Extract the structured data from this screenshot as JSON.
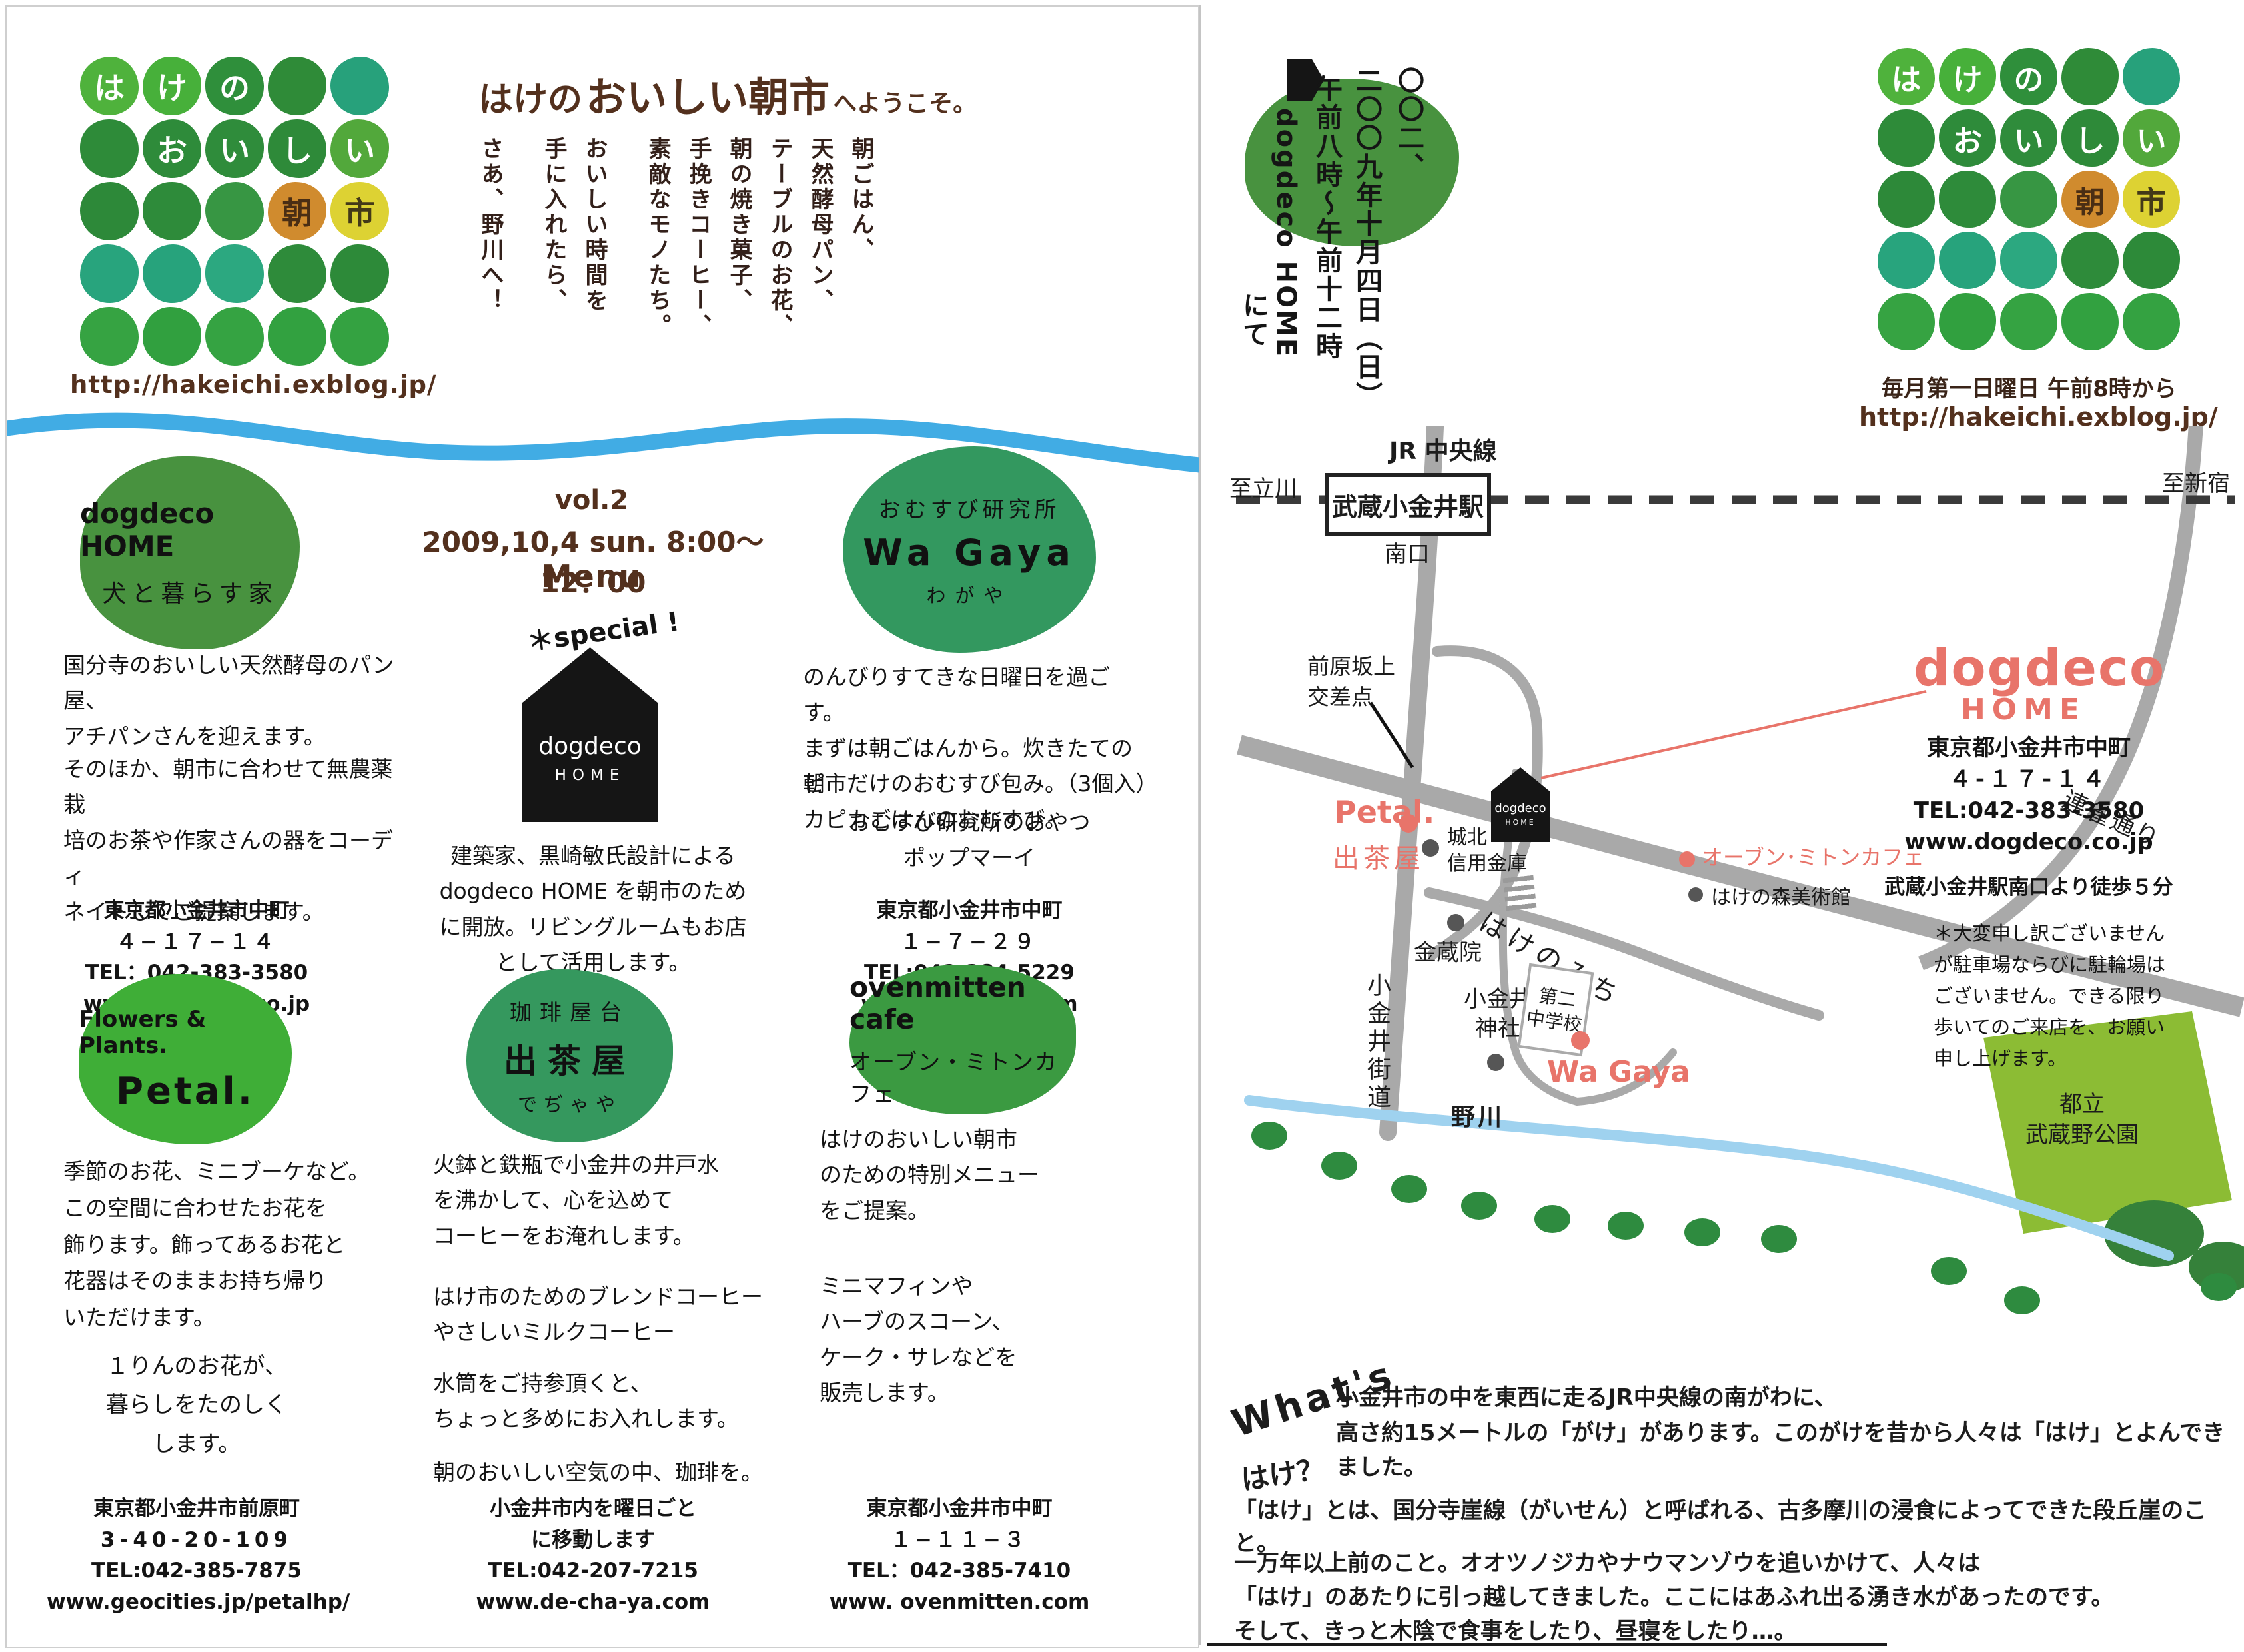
{
  "colors": {
    "brown": "#53301d",
    "pink": "#e8746a",
    "wave_blue": "#41ace4",
    "river_blue": "#9fd2ef",
    "road_gray": "#a9a9a9",
    "park_green": "#8cbc34",
    "tree_green": "#2e8b3f"
  },
  "logo": {
    "url": "http://hakeichi.exblog.jp/",
    "cells": [
      {
        "c": "は",
        "bg": "#4fb23c"
      },
      {
        "c": "け",
        "bg": "#47b03a"
      },
      {
        "c": "の",
        "bg": "#2f8f3b"
      },
      {
        "c": "",
        "bg": "#2f8b38"
      },
      {
        "c": "",
        "bg": "#27a17b"
      },
      {
        "c": "",
        "bg": "#2e8b39"
      },
      {
        "c": "お",
        "bg": "#2e8b3a"
      },
      {
        "c": "い",
        "bg": "#2f8c3b"
      },
      {
        "c": "し",
        "bg": "#2e8a39"
      },
      {
        "c": "い",
        "bg": "#52a83b"
      },
      {
        "c": "",
        "bg": "#2d8939"
      },
      {
        "c": "",
        "bg": "#2e8b3a"
      },
      {
        "c": "",
        "bg": "#379643"
      },
      {
        "c": "朝",
        "bg": "#d08b2e",
        "fg": "#4a2e14"
      },
      {
        "c": "市",
        "bg": "#ddd233",
        "fg": "#433918"
      },
      {
        "c": "",
        "bg": "#28a47d"
      },
      {
        "c": "",
        "bg": "#27a37c"
      },
      {
        "c": "",
        "bg": "#2ca880"
      },
      {
        "c": "",
        "bg": "#2e8b3a"
      },
      {
        "c": "",
        "bg": "#2d8a39"
      },
      {
        "c": "",
        "bg": "#36a342"
      },
      {
        "c": "",
        "bg": "#31a03f"
      },
      {
        "c": "",
        "bg": "#35a342"
      },
      {
        "c": "",
        "bg": "#32a140"
      },
      {
        "c": "",
        "bg": "#34a241"
      }
    ]
  },
  "welcome": {
    "title_1": "はけの",
    "title_2": "おいしい朝市",
    "title_3": "へようこそ。",
    "lines": [
      "朝ごはん、",
      "天然酵母パン、",
      "テーブルのお花、",
      "朝の焼き菓子、",
      "手挽きコーヒー、",
      "素敵なモノたち。",
      "おいしい時間を",
      "手に入れたら、",
      "さあ、野川へ！"
    ]
  },
  "vendors": {
    "dogdeco": {
      "circle_1": "dogdeco HOME",
      "circle_2": "犬と暮らす家",
      "para_1": "国分寺のおいしい天然酵母のパン屋、\nアチパンさんを迎えます。",
      "para_2": "そのほか、朝市に合わせて無農薬栽\n培のお茶や作家さんの器をコーディ\nネイトしてご提案します。",
      "addr": [
        "東京都小金井市中町",
        "４−１７−１４",
        "TEL：042-383-3580",
        "www.dogdeco.co.jp"
      ]
    },
    "event": {
      "vol": "vol.2",
      "date": "2009,10,4 sun. 8:00〜12：00",
      "menu": "Menu",
      "special": "＊special !",
      "house_1": "dogdeco",
      "house_2": "HOME",
      "para": "建築家、黒崎敏氏設計による\ndogdeco HOME を朝市のため\nに開放。リビングルームもお店\nとして活用します。"
    },
    "wagaya": {
      "circle_1": "おむすび研究所",
      "circle_2": "Wa Gaya",
      "circle_3": "わがや",
      "para_1": "のんびりすてきな日曜日を過ごす。\nまずは朝ごはんから。炊きたてのピ\nカピカごはんのおむすび。",
      "para_2": "朝市だけのおむすび包み。（3個入）",
      "para_3": "おむすび研究所のおやつ\nポップマーイ",
      "addr": [
        "東京都小金井市中町",
        "１−７−２９",
        "TEL:042-384-5229",
        "www.wa-gaya.com"
      ]
    },
    "petal": {
      "circle_1": "Flowers & Plants.",
      "circle_2": "Petal.",
      "para_1": "季節のお花、ミニブーケなど。\nこの空間に合わせたお花を\n飾ります。飾ってあるお花と\n花器はそのままお持ち帰り\nいただけます。",
      "para_2": "１りんのお花が、\n暮らしをたのしく\nします。",
      "addr": [
        "東京都小金井市前原町",
        "3-40-20-109",
        "TEL:042-385-7875",
        "www.geocities.jp/petalhp/"
      ]
    },
    "dechaya": {
      "circle_1": "珈琲屋台",
      "circle_2": "出茶屋",
      "circle_3": "でぢゃや",
      "para_1": "火鉢と鉄瓶で小金井の井戸水\nを沸かして、心を込めて\nコーヒーをお淹れします。",
      "para_2": "はけ市のためのブレンドコーヒー\nやさしいミルクコーヒー",
      "para_3": "水筒をご持参頂くと、\nちょっと多めにお入れします。",
      "para_4": "朝のおいしい空気の中、珈琲を。",
      "addr": [
        "小金井市内を曜日ごと",
        "に移動します",
        "TEL:042-207-7215",
        "www.de-cha-ya.com"
      ]
    },
    "ovenmitten": {
      "circle_1": "ovenmitten cafe",
      "circle_2": "オーブン・ミトンカフェ",
      "para_1": "はけのおいしい朝市\nのための特別メニュー\nをご提案。",
      "para_2": "ミニマフィンや\nハーブのスコーン、\nケーク・サレなどを\n販売します。",
      "addr": [
        "東京都小金井市中町",
        "１−１１−３",
        "TEL：042-385-7410",
        "www. ovenmitten.com"
      ]
    }
  },
  "right": {
    "date_cols": [
      "〇〇二、",
      "二〇〇九年十月四日（日）",
      "午前八時〜午前十二時",
      "dogdeco HOME",
      "にて"
    ],
    "schedule": "毎月第一日曜日 午前8時から",
    "url": "http://hakeichi.exblog.jp/",
    "info": {
      "name_1": "dogdeco",
      "name_2": "HOME",
      "addr": [
        "東京都小金井市中町",
        "４-１７-１４",
        "TEL:042-383-3580",
        "www.dogdeco.co.jp"
      ],
      "walk": "武蔵小金井駅南口より徒歩５分",
      "note": "＊大変申し訳ございません\nが駐車場ならびに駐輪場は\nございません。できる限り\n歩いてのご来店を、お願い\n申し上げます。"
    },
    "map": {
      "jr_line": "JR 中央線",
      "to_tachikawa": "至立川",
      "to_shinjuku": "至新宿",
      "station": "武蔵小金井駅",
      "south_exit": "南口",
      "maehara": "前原坂上\n交差点",
      "petal": "Petal.",
      "dechaya": "出茶屋",
      "johoku": "城北\n信用金庫",
      "konzoin": "金蔵院",
      "map_house_1": "dogdeco",
      "map_house_2": "HOME",
      "hakenomichi": "はけのみち",
      "renjaku": "連雀通り",
      "koganei_kaido": "小金井街道",
      "shrine": "小金井\n神社",
      "school": "第二\n中学校",
      "mitten_cafe": "オーブン･ミトンカフェ",
      "museum": "はけの森美術館",
      "wagaya": "Wa Gaya",
      "nogawa": "野川",
      "park": "都立\n武蔵野公園"
    },
    "whats": {
      "w": "What's",
      "h": "はけ？",
      "p1": "小金井市の中を東西に走るJR中央線の南がわに、\n高さ約15メートルの「がけ」があります。このがけを昔から人々は「はけ」とよんできました。",
      "p2": "「はけ」とは、国分寺崖線（がいせん）と呼ばれる、古多摩川の浸食によってできた段丘崖のこと。",
      "p3": "一万年以上前のこと。オオツノジカやナウマンゾウを追いかけて、人々は\n「はけ」のあたりに引っ越してきました。ここにはあふれ出る湧き水があったのです。\nそして、きっと木陰で食事をしたり、昼寝をしたり…。"
    }
  }
}
